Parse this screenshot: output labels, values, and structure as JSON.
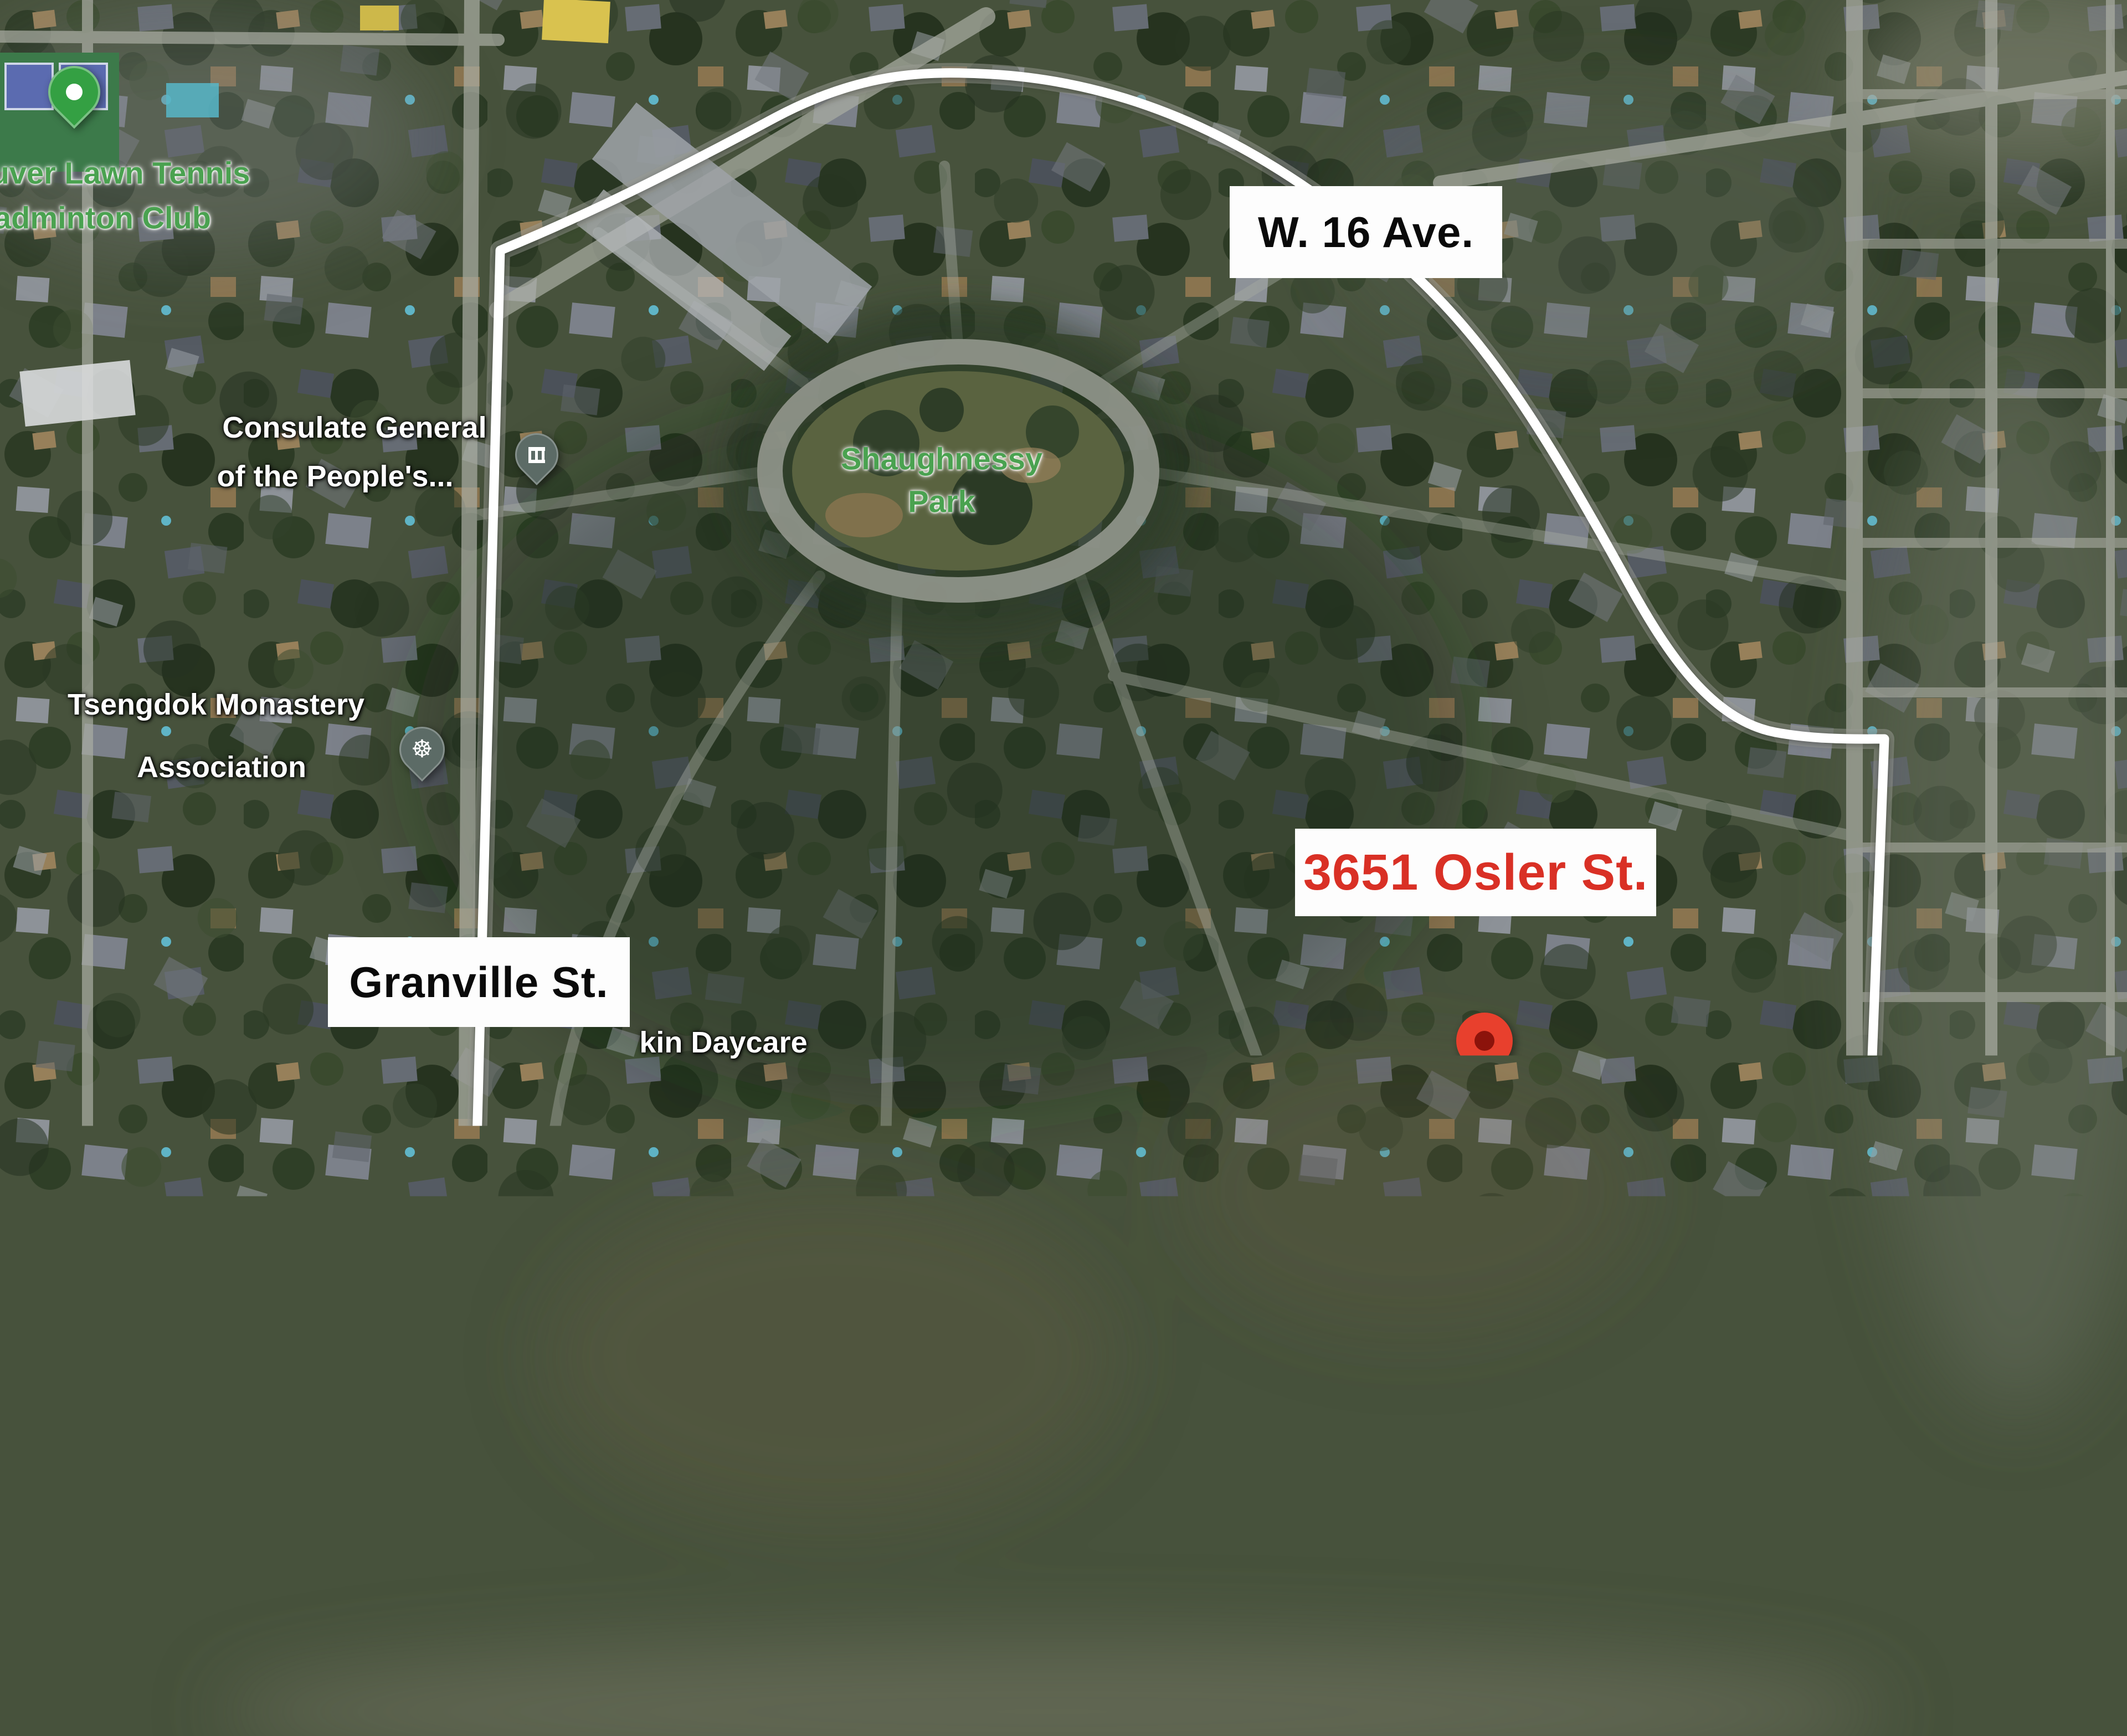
{
  "street_labels": {
    "w16_ave": "W. 16 Ave.",
    "granville": "Granville St.",
    "oak": "Oak St.",
    "king_edward": "W. King Edward"
  },
  "property_label": "3651 Osler St.",
  "poi": {
    "tennis_line1": "uver Lawn Tennis",
    "tennis_line2": "adminton Club",
    "consulate_line1": "Consulate General",
    "consulate_line2": "of the People's...",
    "monastery_line1": "Tsengdok Monastery",
    "monastery_line2": "Association",
    "park_line1": "Shaughnessy",
    "park_line2": "Park",
    "daycare": "kin Daycare",
    "church_line1": "Redeemer",
    "church_line2": "Lutheran Church",
    "school_right_line1": "Emily C",
    "school_right_line2": "Elementary",
    "school_bottom": "se School"
  },
  "colors": {
    "boundary": "#ffffff",
    "street_label_bg": "#fdfdfd",
    "street_label_text": "#0a0a0a",
    "property_label_text": "#d93025",
    "poi_label_green": "#4aa250",
    "poi_pin_gray": "#5c6b66",
    "poi_pin_green": "#34a043",
    "property_pin": "#e8402d"
  }
}
